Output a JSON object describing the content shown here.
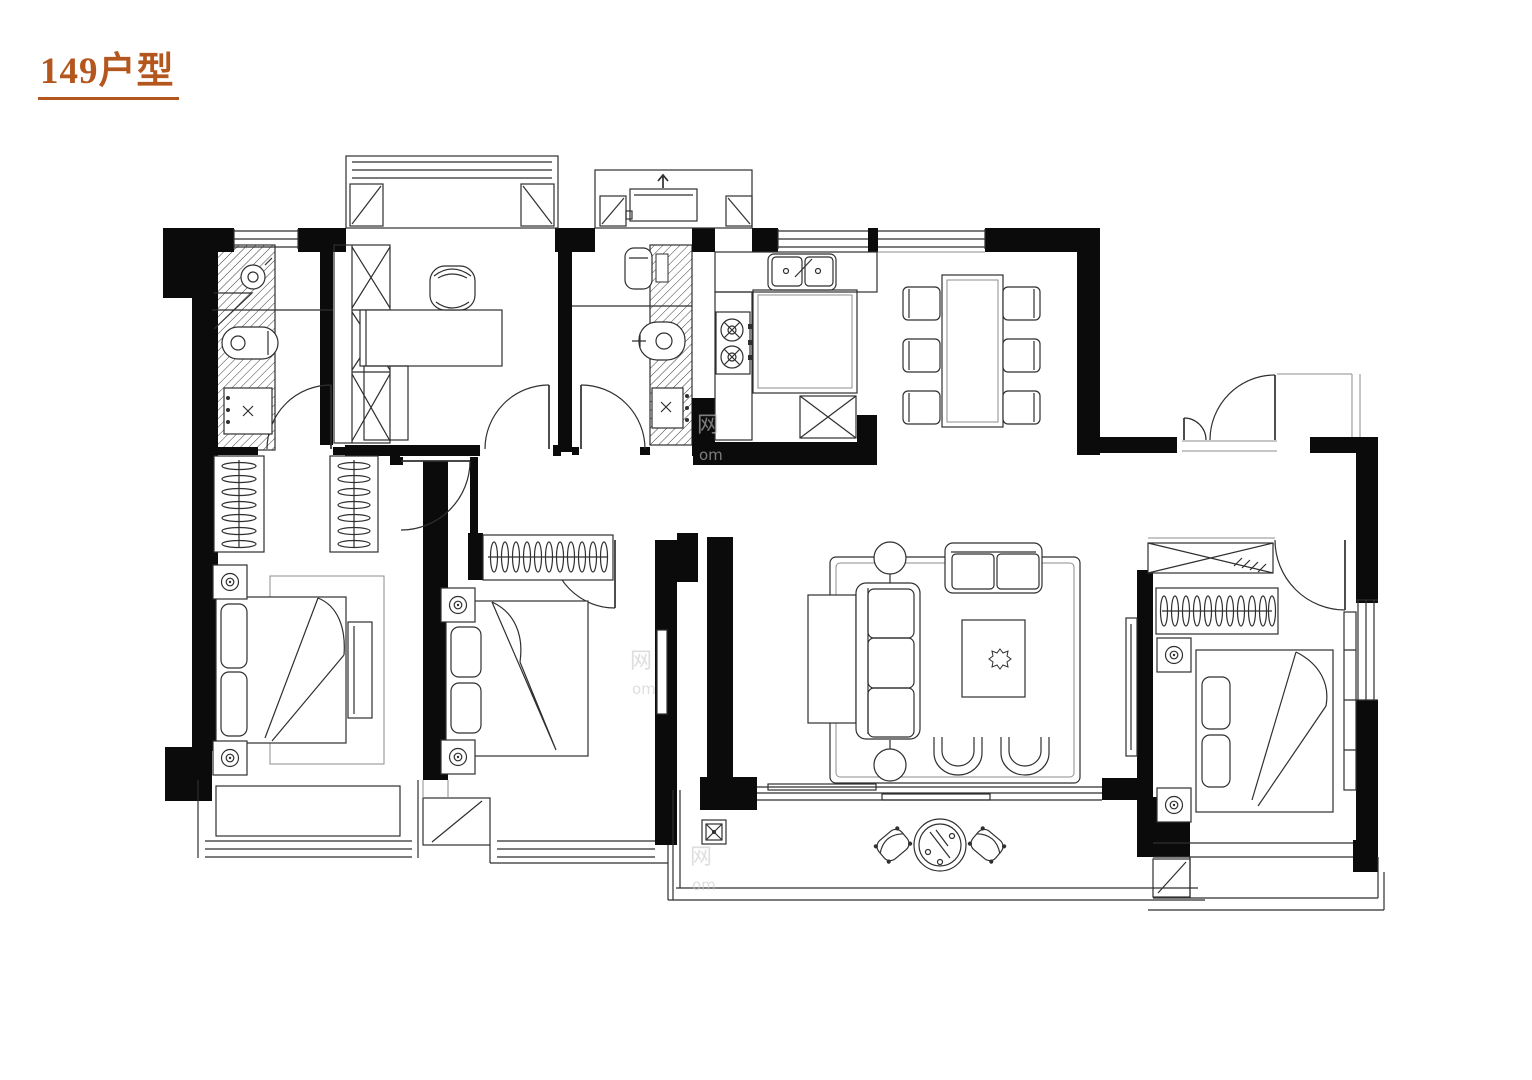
{
  "header": {
    "title": "149户型",
    "title_color": "#b4571f"
  },
  "watermark": {
    "glyph": "网",
    "latin": "om"
  }
}
